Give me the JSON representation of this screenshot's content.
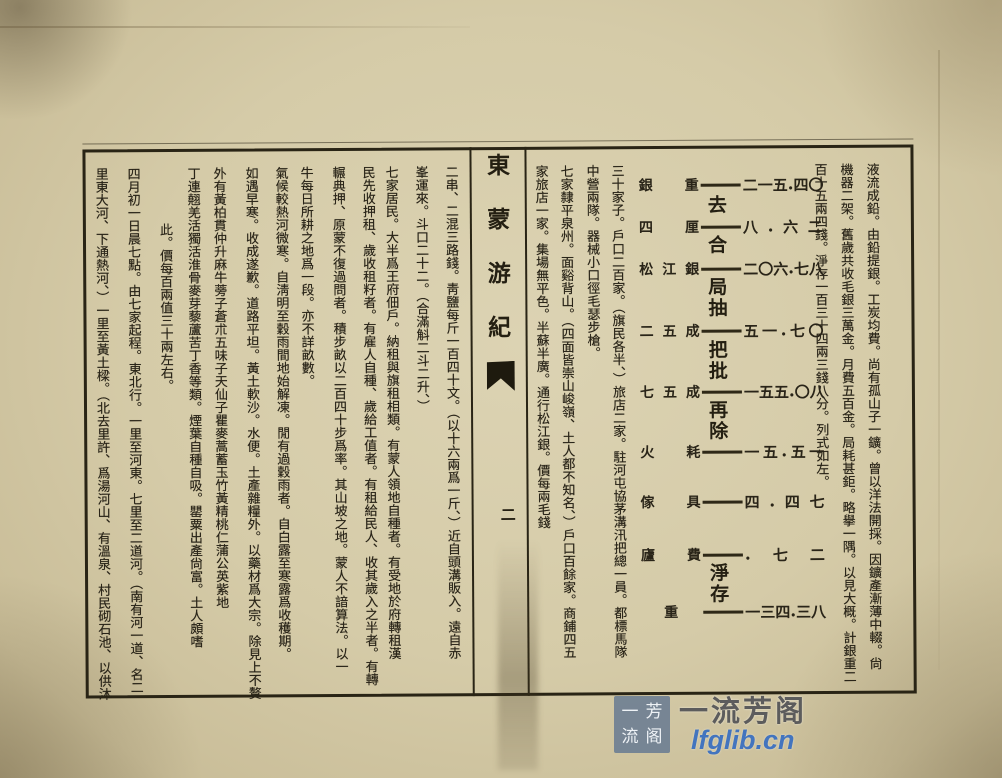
{
  "book": {
    "title": "東蒙游紀",
    "page_number": "二"
  },
  "right_page": {
    "columns_before_table": [
      "液流成鉛。由鉛提銀。工炭均費。尚有孤山子一鑛。曾以洋法開採。因鑛產漸薄中輟。尙",
      "機器二架。舊歲共收毛銀三萬金。月費五百金。局耗甚鉅。略擧一隅。以見大概。計銀重二",
      "百十五兩四錢。淨存一百三十四兩三錢八分。列式如左。"
    ],
    "table": {
      "description": "silver refining ledger (taels)",
      "rows": [
        {
          "label": "銀重",
          "digits": "二一五·四〇",
          "value": 215.4,
          "op_after": "去"
        },
        {
          "label": "四厘",
          "digits": "八·六二",
          "value": 8.62,
          "op_after": "合"
        },
        {
          "label": "松江銀",
          "digits": "二〇六·七八",
          "value": 206.78,
          "op_after": "局抽"
        },
        {
          "label": "二五成",
          "digits": "五一·七〇",
          "value": 51.7,
          "op_after": "把批"
        },
        {
          "label": "七五成",
          "digits": "一五五·〇八",
          "value": 155.08,
          "op_after": "再除"
        },
        {
          "label": "火耗",
          "digits": "一五·五一",
          "value": 15.51
        },
        {
          "label": "傢具",
          "digits": "四·四七",
          "value": 4.47
        },
        {
          "label": "廬費",
          "digits": "·七二",
          "value": 0.72,
          "op_after": "淨存"
        },
        {
          "label": "重",
          "digits": "一三四·三八",
          "value": 134.38
        }
      ]
    },
    "columns_after_table": [
      "三十家子。戶口二百家。（旗民各半、）旅店二家。駐河屯協茅溝汛把總一員。都標馬隊",
      "中營兩隊。器械小口徑毛瑟步槍。",
      "七家隸平泉州。面谿背山。（四面皆崇山峻嶺、土人都不知名、）戶口百餘家。商鋪四五",
      "家旅店一家。集場無平色。半蘇半廣。通行松江銀。價每兩毛錢"
    ]
  },
  "left_page": {
    "columns": [
      "二串、二混三路錢。靑鹽每斤一百四十文。（以十六兩爲一斤、）近自頭溝販入。遠自赤",
      "峯運來。斗口二十二。（合滿斛二斗二升、）",
      "七家居民。大半爲王府佃戶。納租與旗租相類。有蒙人領地自種者。有受地於府轉租漢",
      "民先收押租、歲收租籽者。有雇人自種、歲給工值者。有租給民人、收其歲入之半者。有轉",
      "輾典押、原蒙不復過問者。積步畝以二百四十步爲率。其山坡之地。蒙人不諳算法。以一",
      "牛每日所耕之地爲一段。亦不詳畝數。",
      "氣候較熱河微寒。自淸明至穀雨間地始解凍。閒有過穀雨者。自白露至寒露爲收穫期。",
      "如遇早寒。收成遂歉。道路平坦。黃土軟沙。水便。土產雜糧外。以藥材爲大宗。除見上不贅",
      "外有黃柏貫仲升麻牛蒡子蒼朮五味子天仙子瞿麥蒿蓄玉竹黃精桃仁蒲公英紫地",
      "丁連翹羌活獨活淮骨麥芽藜蘆苦丁香等類。煙葉自種自吸。罌粟出產尙富。土人頗嗜",
      "此。價每百兩值三十兩左右。",
      "四月初一日晨七點。由七家起程。東北行。一里至河東。七里至二道河。（南有河一道、名二",
      "里東大河、下通熱河、）一里至黃土樑。（北去里許、爲湯河山、有溫泉、村民砌石池、以供沐"
    ]
  },
  "spine": {
    "title": "東蒙游紀",
    "page_number": "二"
  },
  "watermark": {
    "name": "一流芳阁",
    "url": "lfglib.cn",
    "logo_chars": [
      "一",
      "流",
      "芳",
      "阁"
    ]
  },
  "colors": {
    "paper": "#d5cba8",
    "ink": "#292418",
    "frame": "#292415",
    "watermark_blue": "#3a6fbe",
    "watermark_gray": "#505052",
    "logo_bg": "#6a7c92"
  }
}
